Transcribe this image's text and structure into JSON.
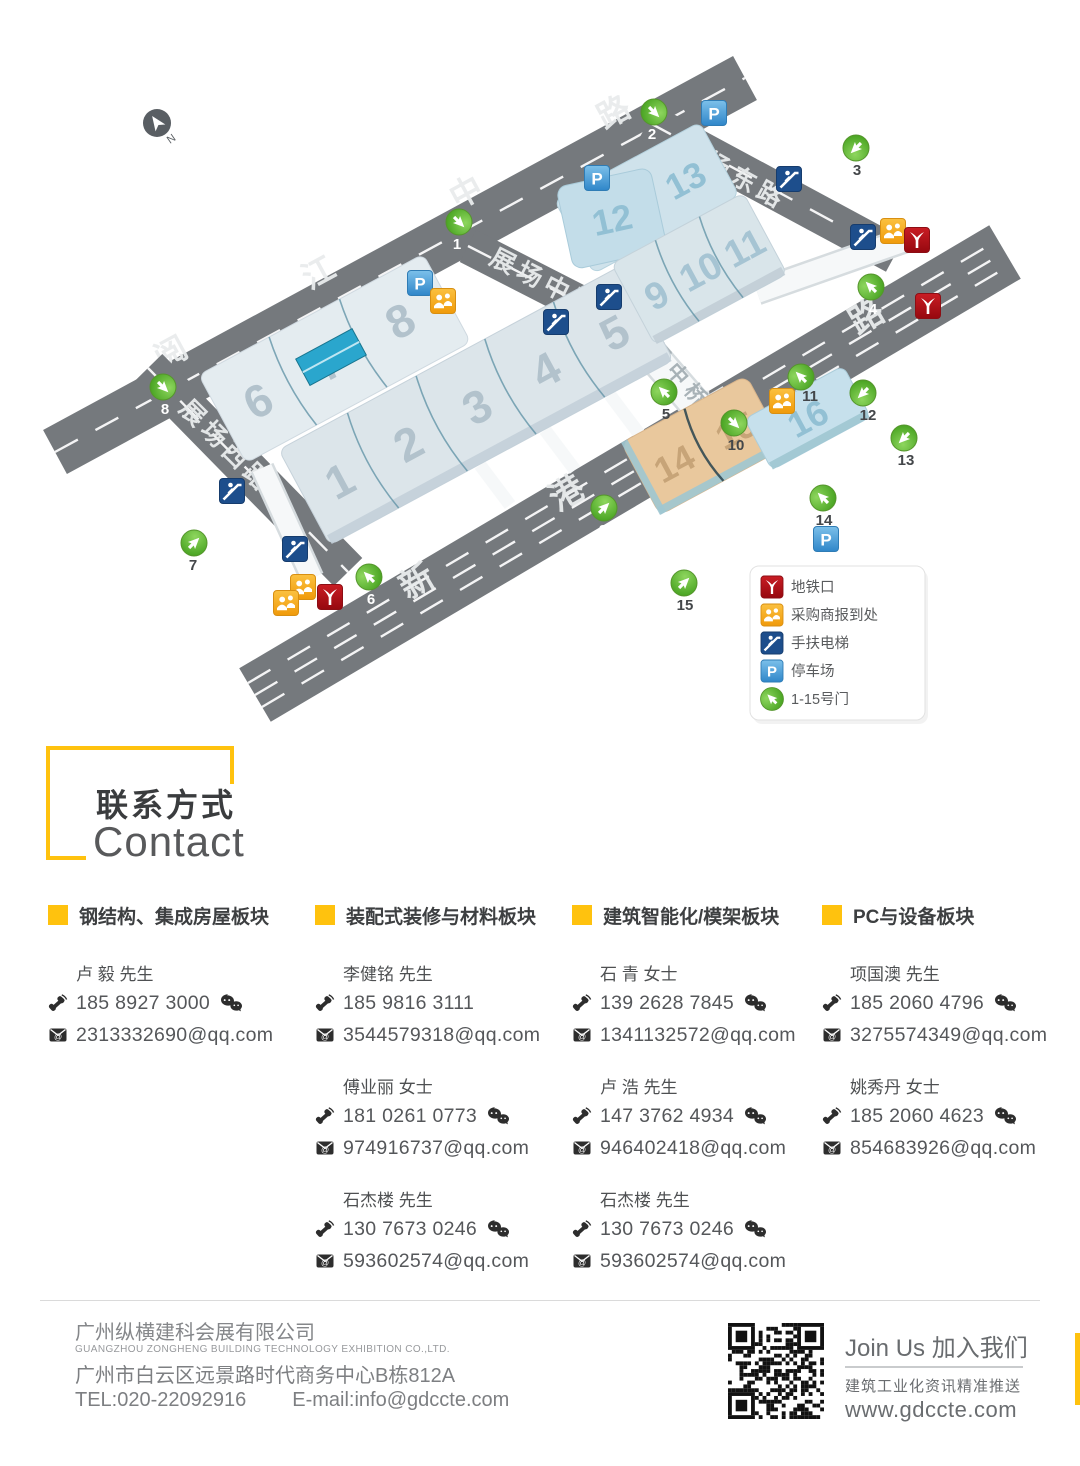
{
  "map": {
    "compass": "N",
    "parking_glyph": "P",
    "roads": {
      "yuejiang": "阅江中路",
      "zhanchang_east": "展场东路",
      "zhanchang_middle": "展场中路",
      "zhanchang_west": "展场西路",
      "xingang_east": "新港东路",
      "bridge": "展场中桥"
    },
    "halls": [
      "1",
      "2",
      "3",
      "4",
      "5",
      "6",
      "7",
      "8",
      "9",
      "10",
      "11",
      "12",
      "13",
      "14",
      "15",
      "16"
    ],
    "gates": [
      "1",
      "2",
      "3",
      "4",
      "5",
      "6",
      "7",
      "8",
      "9",
      "10",
      "11",
      "12",
      "13",
      "14",
      "15"
    ],
    "legend": [
      {
        "icon": "metro-icon",
        "label": "地铁口"
      },
      {
        "icon": "buyer-registration-icon",
        "label": "采购商报到处"
      },
      {
        "icon": "escalator-icon",
        "label": "手扶电梯"
      },
      {
        "icon": "parking-icon",
        "label": "停车场"
      },
      {
        "icon": "gate-icon",
        "label": "1-15号门"
      }
    ]
  },
  "icons": {
    "mail_at": "@"
  },
  "contact_header": {
    "cn": "联系方式",
    "en": "Contact"
  },
  "sections": [
    {
      "title": "钢结构、集成房屋板块",
      "contacts": [
        {
          "name": "卢 毅 先生",
          "phone": "185 8927 3000",
          "email": "2313332690@qq.com"
        }
      ]
    },
    {
      "title": "装配式装修与材料板块",
      "contacts": [
        {
          "name": "李健铭 先生",
          "phone": "185 9816 3111",
          "email": "3544579318@qq.com"
        },
        {
          "name": "傅业丽 女士",
          "phone": "181 0261 0773",
          "email": "974916737@qq.com"
        },
        {
          "name": "石杰楼 先生",
          "phone": "130 7673 0246",
          "email": "593602574@qq.com"
        }
      ]
    },
    {
      "title": "建筑智能化/模架板块",
      "contacts": [
        {
          "name": "石 青 女士",
          "phone": "139 2628 7845",
          "email": "1341132572@qq.com"
        },
        {
          "name": "卢 浩 先生",
          "phone": "147 3762 4934",
          "email": "946402418@qq.com"
        },
        {
          "name": "石杰楼 先生",
          "phone": "130 7673 0246",
          "email": "593602574@qq.com"
        }
      ]
    },
    {
      "title": "PC与设备板块",
      "contacts": [
        {
          "name": "项国澳 先生",
          "phone": "185 2060 4796",
          "email": "3275574349@qq.com"
        },
        {
          "name": "姚秀丹 女士",
          "phone": "185 2060 4623",
          "email": "854683926@qq.com"
        }
      ]
    }
  ],
  "footer": {
    "company_cn": "广州纵横建科会展有限公司",
    "company_en": "GUANGZHOU ZONGHENG BUILDING TECHNOLOGY EXHIBITION CO.,LTD.",
    "address": "广州市白云区远景路时代商务中心B栋812A",
    "tel": "TEL:020-22092916",
    "email": "E-mail:info@gdccte.com",
    "join_title": "Join Us 加入我们",
    "join_sub": "建筑工业化资讯精准推送",
    "website": "www.gdccte.com"
  }
}
